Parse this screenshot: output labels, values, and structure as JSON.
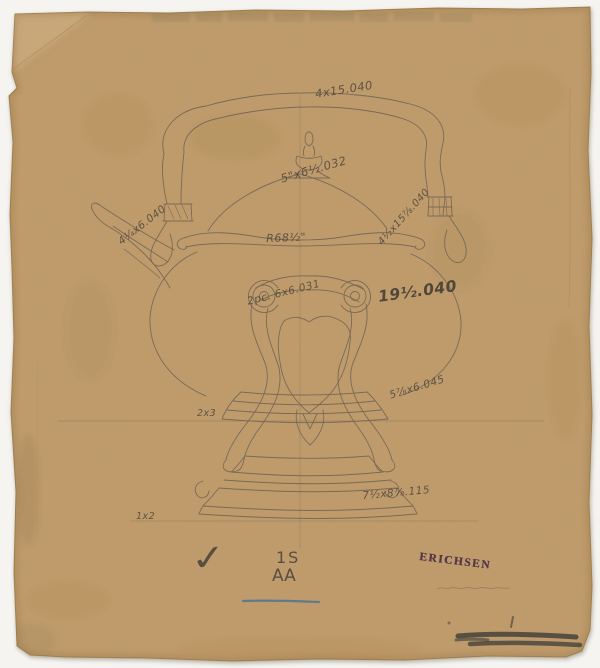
{
  "artifact": {
    "description_visible": "pencil working drawing of a tea kettle on scrolled stand, on brown paper",
    "colors": {
      "paper": "#c09c6c",
      "margin": "#f5f4f1",
      "pencil": "#6a6052",
      "stamp_ink": "#472c44",
      "blue_pencil_line": "#4a6f96",
      "graphite_smudge": "#3c3c38"
    }
  },
  "annotations": {
    "top_dim": "4x15.040",
    "dome_dim": "5\"x6½.032",
    "left_dim": "4¼x6.040",
    "right_dim": "4½x15⅞.040",
    "radius_note": "R68½\"",
    "pieces_note": "2pc. 6x6.031",
    "gauge_large": "19½.040",
    "right_lower_dim": "5⅞x6.045",
    "left_small_dim": "2x3",
    "base_dim": "7½x8⅞.115",
    "bottom_left_dim": "1x2",
    "check_mark": "✓",
    "mark_line1": "1S",
    "mark_line2": "AA",
    "stamp": "ERICHSEN"
  }
}
